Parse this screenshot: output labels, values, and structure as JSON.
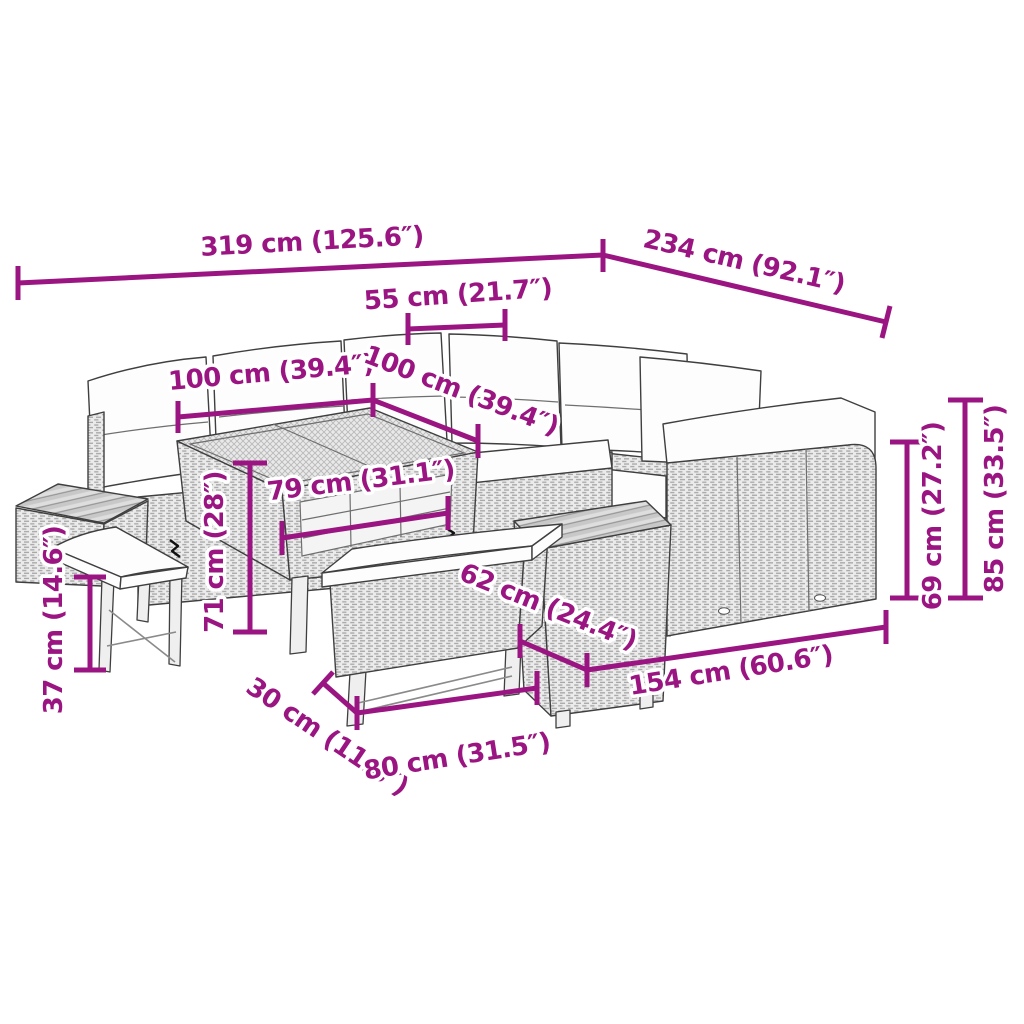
{
  "colors": {
    "accent": "#9A1581",
    "line_art": "#3f3f3f"
  },
  "dimensions": {
    "total_width": "319 cm (125.6″)",
    "total_depth": "234 cm (92.1″)",
    "seat_width": "55 cm (21.7″)",
    "table_length": "100 cm (39.4″)",
    "table_width": "100 cm (39.4″)",
    "table_frame_length": "79 cm (31.1″)",
    "table_height": "71 cm (28″)",
    "stool_height": "37 cm (14.6″)",
    "bench_depth": "30 cm (11.8″)",
    "bench_length": "80 cm (31.5″)",
    "side_table_length": "62 cm (24.4″)",
    "sofa_section_length": "154 cm (60.6″)",
    "seat_back_height": "69 cm (27.2″)",
    "total_height": "85 cm (33.5″)"
  }
}
